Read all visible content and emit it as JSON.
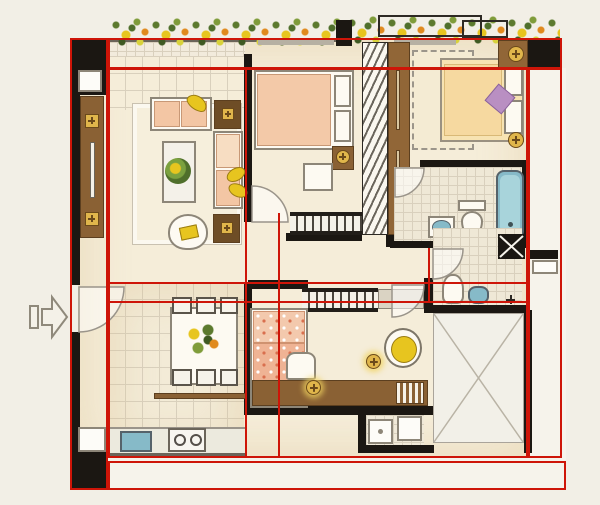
{
  "canvas": {
    "width": 600,
    "height": 505
  },
  "palette": {
    "page-bg": "#f2efe6",
    "outside": "#f6f3eb",
    "cream-floor": "#f5edd9",
    "tile-line": "#d9d0bd",
    "wall": "#1b1712",
    "wood": "#8a6134",
    "wood-dark": "#5c3f1f",
    "peach": "#f3c6a4",
    "yellow": "#e7c51f",
    "fixture-blue": "#86bac8",
    "purple": "#b98fc2",
    "salmon": "#efb394",
    "red": "#ce1508"
  },
  "icons": {
    "entry_arrow": "right-pointing outlined arrow marking the unit entrance"
  },
  "red_overlay": {
    "color": "#ce1508",
    "rects": [
      {
        "name": "red-box-left-wall-strip",
        "x": 70,
        "y": 38,
        "w": 38,
        "h": 452
      },
      {
        "name": "red-box-top-balcony-strip",
        "x": 108,
        "y": 38,
        "w": 454,
        "h": 31
      },
      {
        "name": "red-box-right-side-strip",
        "x": 528,
        "y": 68,
        "w": 34,
        "h": 390
      },
      {
        "name": "red-box-main-interior",
        "x": 108,
        "y": 68,
        "w": 420,
        "h": 390
      },
      {
        "name": "red-box-corridor-strip",
        "x": 108,
        "y": 282,
        "w": 420,
        "h": 21
      },
      {
        "name": "red-box-bottom-strip",
        "x": 108,
        "y": 461,
        "w": 458,
        "h": 29
      }
    ],
    "segments": [
      {
        "name": "red-line-living-divider",
        "x": 245,
        "y": 68,
        "len": 390,
        "dir": "v"
      },
      {
        "name": "red-line-bedroom3-divider",
        "x": 278,
        "y": 213,
        "len": 245,
        "dir": "v"
      },
      {
        "name": "red-line-bathroom2-divider",
        "x": 428,
        "y": 248,
        "len": 55,
        "dir": "v"
      }
    ]
  }
}
